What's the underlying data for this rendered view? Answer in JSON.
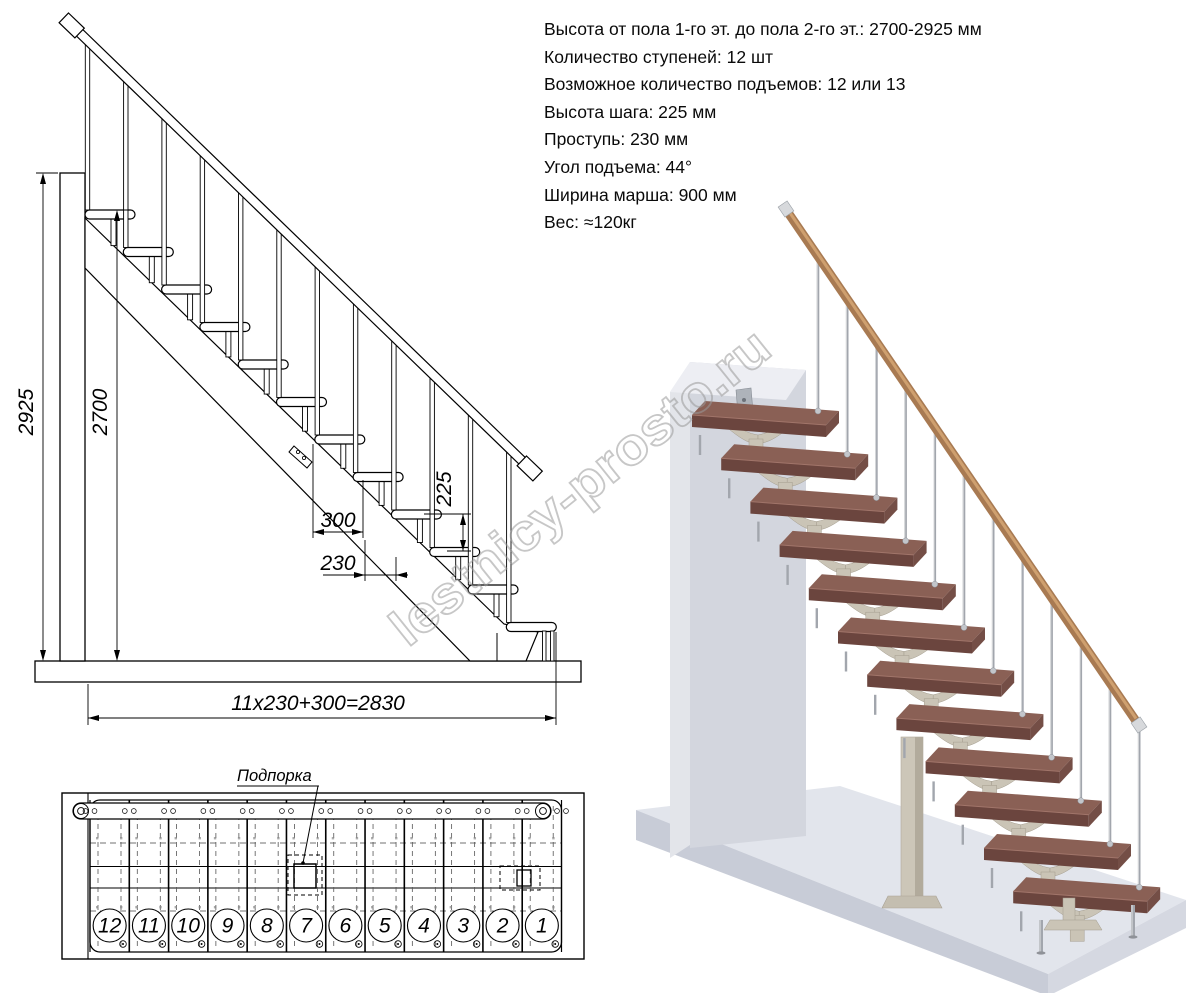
{
  "watermark": {
    "text": "lestnicy-prosto.ru"
  },
  "specs": {
    "lines": [
      "Высота от пола 1-го эт. до пола 2-го эт.: 2700-2925 мм",
      "Количество ступеней: 12 шт",
      "Возможное количество подъемов: 12 или 13",
      "Высота шага: 225 мм",
      "Проступь: 230 мм",
      "Угол подъема: 44°",
      "Ширина марша: 900 мм",
      "Вес: ≈120кг"
    ]
  },
  "elevation": {
    "step_count": 12,
    "dim_total_height": "2925",
    "dim_floor_to_floor": "2700",
    "dim_riser_height": "225",
    "dim_top_run": "300",
    "dim_tread_depth": "230",
    "dim_total_run": "11x230+300=2830"
  },
  "plan": {
    "support_label": "Подпорка",
    "step_numbers": [
      "12",
      "11",
      "10",
      "9",
      "8",
      "7",
      "6",
      "5",
      "4",
      "3",
      "2",
      "1"
    ]
  },
  "render3d": {
    "step_count": 12,
    "colors": {
      "tread_top": "#8a6055",
      "tread_front": "#6b453e",
      "tread_side": "#744e46",
      "tread_edge": "#a1756a",
      "bracket": "#cac4b6",
      "bracket_line": "#a39c8d",
      "post": "#ccc6b8",
      "post_shade": "#b2ab9c",
      "wall_front": "#d3d6de",
      "wall_side": "#e3e5ea",
      "wall_top": "#edeef3",
      "floor_top": "#e2e5ec",
      "floor_front": "#c8ccd7",
      "floor_side": "#d5d8e1",
      "baluster": "#a2a6ad",
      "baluster_hl": "#d8dadc",
      "handrail": "#a87a52",
      "handrail_hl": "#cfa06f",
      "metal_cap": "#d7d9dc"
    }
  }
}
